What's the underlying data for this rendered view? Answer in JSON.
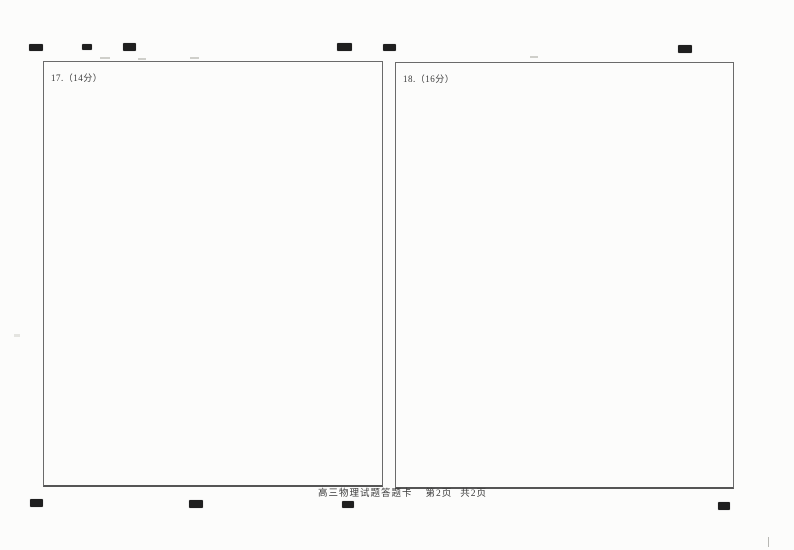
{
  "document": {
    "answer_boxes": [
      {
        "label": "17.（14分）"
      },
      {
        "label": "18.（16分）"
      }
    ],
    "footer": {
      "title": "高三物理试题答题卡",
      "page": "第2页",
      "pages_total": "共2页"
    }
  },
  "registration_marks": {
    "count_top": 6,
    "count_bottom": 4
  },
  "colors": {
    "paper": "#fcfcfb",
    "box_border": "#6a6a6a",
    "registration_mark": "#1f1f1f",
    "text": "#3a3a3a"
  }
}
